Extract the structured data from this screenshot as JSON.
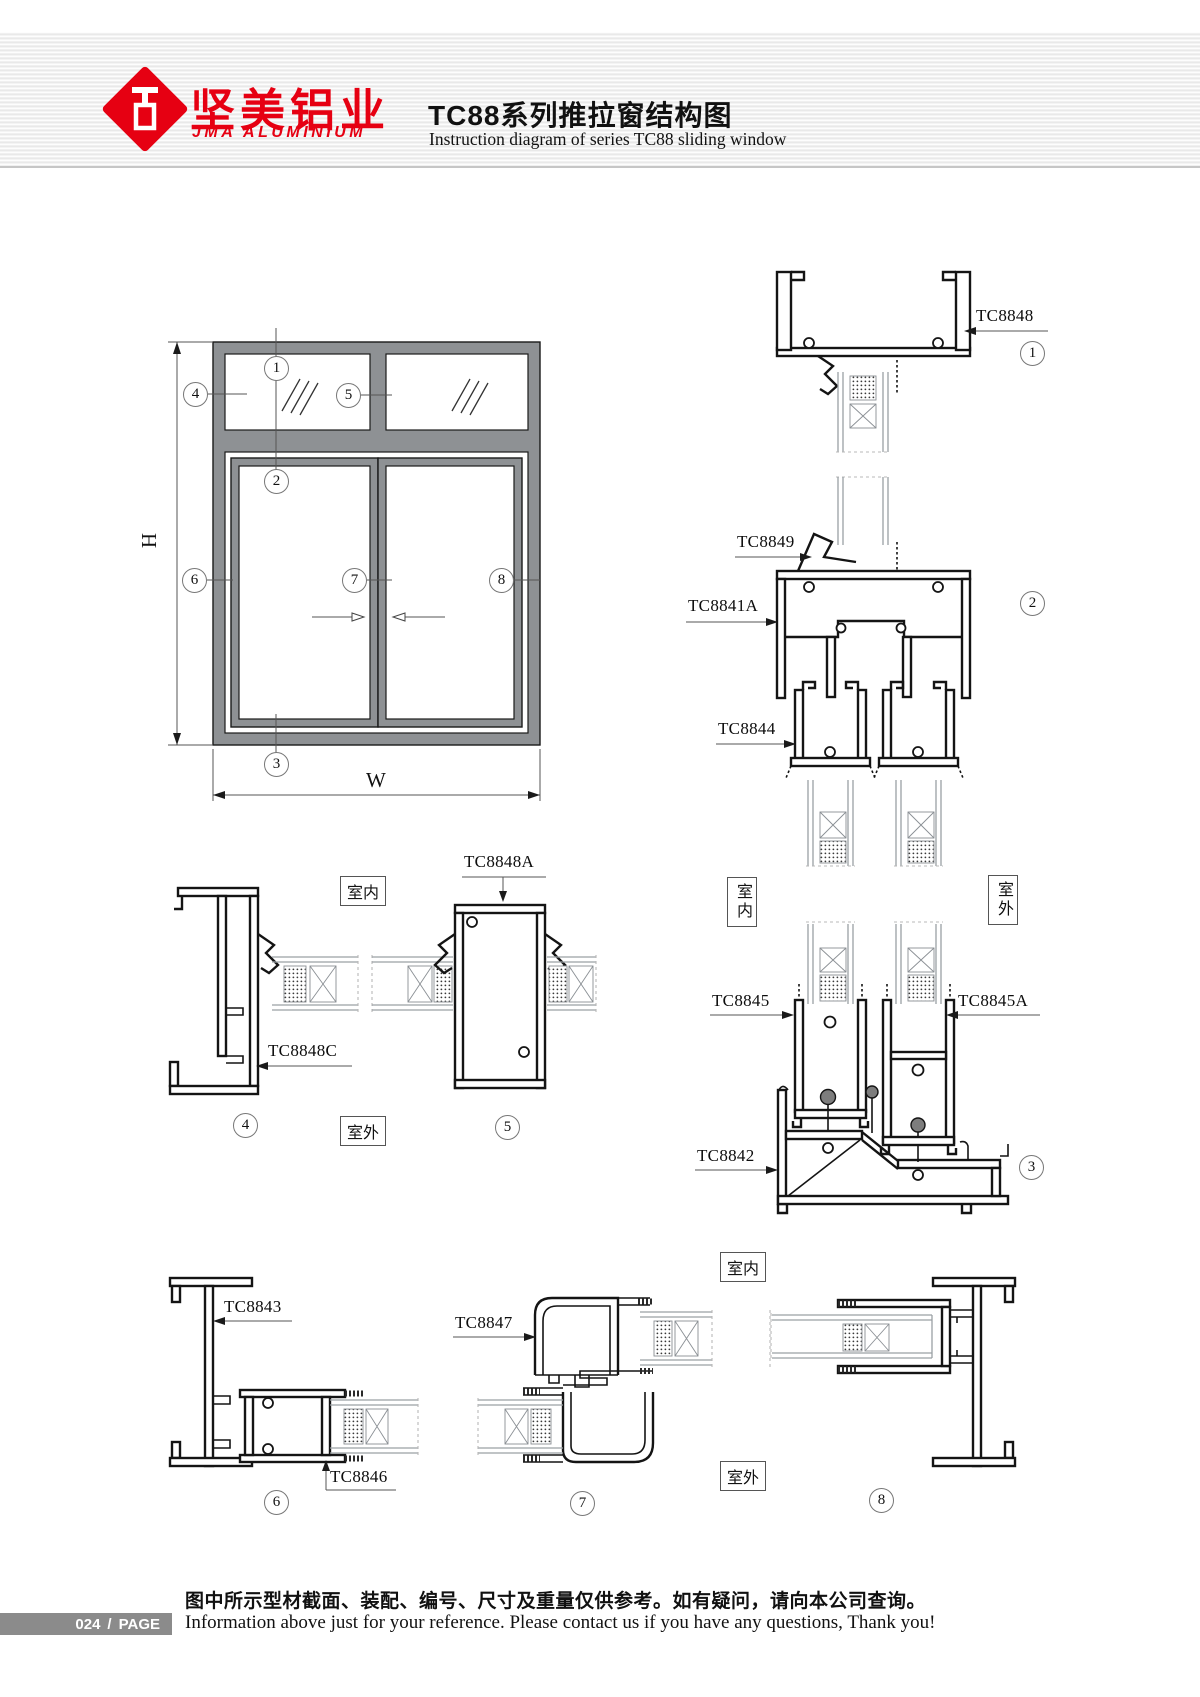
{
  "header": {
    "brand_cn": "坚美铝业",
    "brand_en": "JMA ALUMINIUM",
    "title_cn": "TC88系列推拉窗结构图",
    "title_en": "Instruction diagram of series TC88 sliding window"
  },
  "elevation": {
    "dim_height": "H",
    "dim_width": "W"
  },
  "callouts": {
    "c1": "1",
    "c2": "2",
    "c3": "3",
    "c4": "4",
    "c5": "5",
    "c6": "6",
    "c7": "7",
    "c8": "8"
  },
  "rooms": {
    "indoor": "室内",
    "outdoor": "室外"
  },
  "parts": {
    "tc8848": "TC8848",
    "tc8849": "TC8849",
    "tc8841a": "TC8841A",
    "tc8844": "TC8844",
    "tc8848a": "TC8848A",
    "tc8848c": "TC8848C",
    "tc8845": "TC8845",
    "tc8845a": "TC8845A",
    "tc8842": "TC8842",
    "tc8843": "TC8843",
    "tc8846": "TC8846",
    "tc8847": "TC8847"
  },
  "footer": {
    "page_number": "024",
    "separator": "/",
    "page_label": "PAGE",
    "note_cn": "图中所示型材截面、装配、编号、尺寸及重量仅供参考。如有疑问，请向本公司查询。",
    "note_en": "Information above just for your reference. Please contact us if you have any questions, Thank you!"
  }
}
